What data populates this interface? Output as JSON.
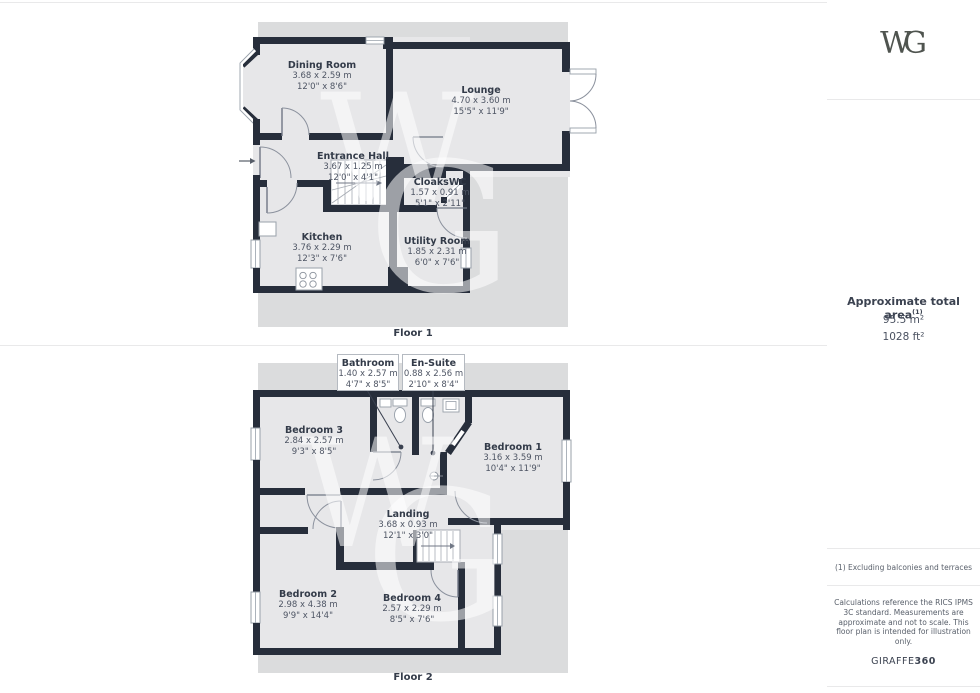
{
  "watermark": {
    "w": "W",
    "g": "G"
  },
  "floors": [
    {
      "label": "Floor 1",
      "rooms": [
        {
          "name": "Dining Room",
          "metric": "3.68 x 2.59 m",
          "imperial": "12'0\" x 8'6\""
        },
        {
          "name": "Lounge",
          "metric": "4.70 x 3.60 m",
          "imperial": "15'5\" x 11'9\""
        },
        {
          "name": "Entrance Hall",
          "metric": "3.67 x 1.25 m",
          "imperial": "12'0\" x 4'1\""
        },
        {
          "name": "CloaksWC",
          "metric": "1.57 x 0.91 m",
          "imperial": "5'1\" x 2'11\""
        },
        {
          "name": "Kitchen",
          "metric": "3.76 x 2.29 m",
          "imperial": "12'3\" x 7'6\""
        },
        {
          "name": "Utility Room",
          "metric": "1.85 x 2.31 m",
          "imperial": "6'0\" x 7'6\""
        }
      ]
    },
    {
      "label": "Floor 2",
      "rooms": [
        {
          "name": "Bathroom",
          "metric": "1.40 x 2.57 m",
          "imperial": "4'7\" x 8'5\""
        },
        {
          "name": "En-Suite",
          "metric": "0.88 x 2.56 m",
          "imperial": "2'10\" x 8'4\""
        },
        {
          "name": "Bedroom 3",
          "metric": "2.84 x 2.57 m",
          "imperial": "9'3\" x 8'5\""
        },
        {
          "name": "Bedroom 1",
          "metric": "3.16 x 3.59 m",
          "imperial": "10'4\" x 11'9\""
        },
        {
          "name": "Landing",
          "metric": "3.68 x 0.93 m",
          "imperial": "12'1\" x 3'0\""
        },
        {
          "name": "Bedroom 2",
          "metric": "2.98 x 4.38 m",
          "imperial": "9'9\" x 14'4\""
        },
        {
          "name": "Bedroom 4",
          "metric": "2.57 x 2.29 m",
          "imperial": "8'5\" x 7'6\""
        }
      ]
    }
  ],
  "sidebar": {
    "logo_w": "W",
    "logo_g": "G",
    "area_title": "Approximate total area",
    "area_note_ref": "(1)",
    "area_m2": "95.5 m²",
    "area_ft2": "1028 ft²",
    "footnote": "(1) Excluding balconies and terraces",
    "disclaimer": "Calculations reference the RICS IPMS 3C standard. Measurements are approximate and not to scale. This floor plan is intended for illustration only.",
    "brand_name": "GIRAFFE",
    "brand_suffix": "360"
  }
}
